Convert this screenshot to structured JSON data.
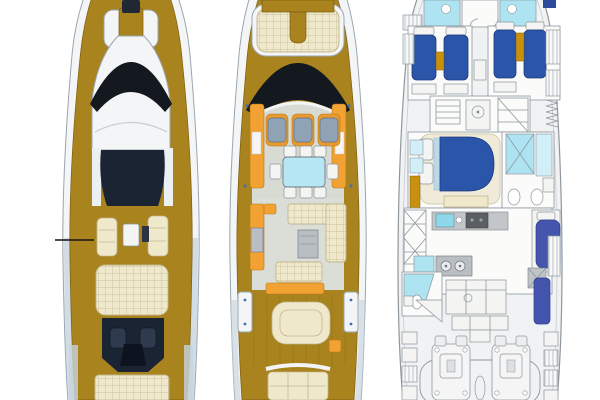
{
  "figure": {
    "type": "yacht-deck-plans",
    "views": [
      {
        "id": "exterior-top-view"
      },
      {
        "id": "main-deck-plan"
      },
      {
        "id": "lower-deck-plan"
      }
    ]
  },
  "colors": {
    "background": "#FFFFFF",
    "teak_gold": "#A8831E",
    "teak_gold_dark": "#7C5E0F",
    "gold_accent": "#C8900F",
    "hull_white": "#F3F5F6",
    "hull_outline": "#9AA6AF",
    "hull_shading": "#C7D3DD",
    "windshield_black": "#14181F",
    "flybridge_navy": "#1B2433",
    "console_navy_dark": "#0D1420",
    "cushion_cream": "#EFE8CB",
    "cushion_seam": "#C2B68D",
    "deck_gray": "#D7DBD3",
    "salon_gray": "#DBDED6",
    "galley_orange": "#F2A133",
    "table_cyan": "#B7E7F4",
    "bed_blue": "#2B55A8",
    "berth_indigo": "#4555AE",
    "bath_cyan": "#AEE4F2",
    "bath_cyan_light": "#D2EFF8",
    "plan_fill": "#F0F2F3",
    "plan_line": "#8E979E",
    "appliance_gray": "#B9BEC2",
    "stove_gray": "#5A5F63",
    "seat_bluegray": "#8FA3B5",
    "white_furniture": "#F4F5F2",
    "room_white": "#FBFBF9",
    "annotation": "#151515"
  }
}
